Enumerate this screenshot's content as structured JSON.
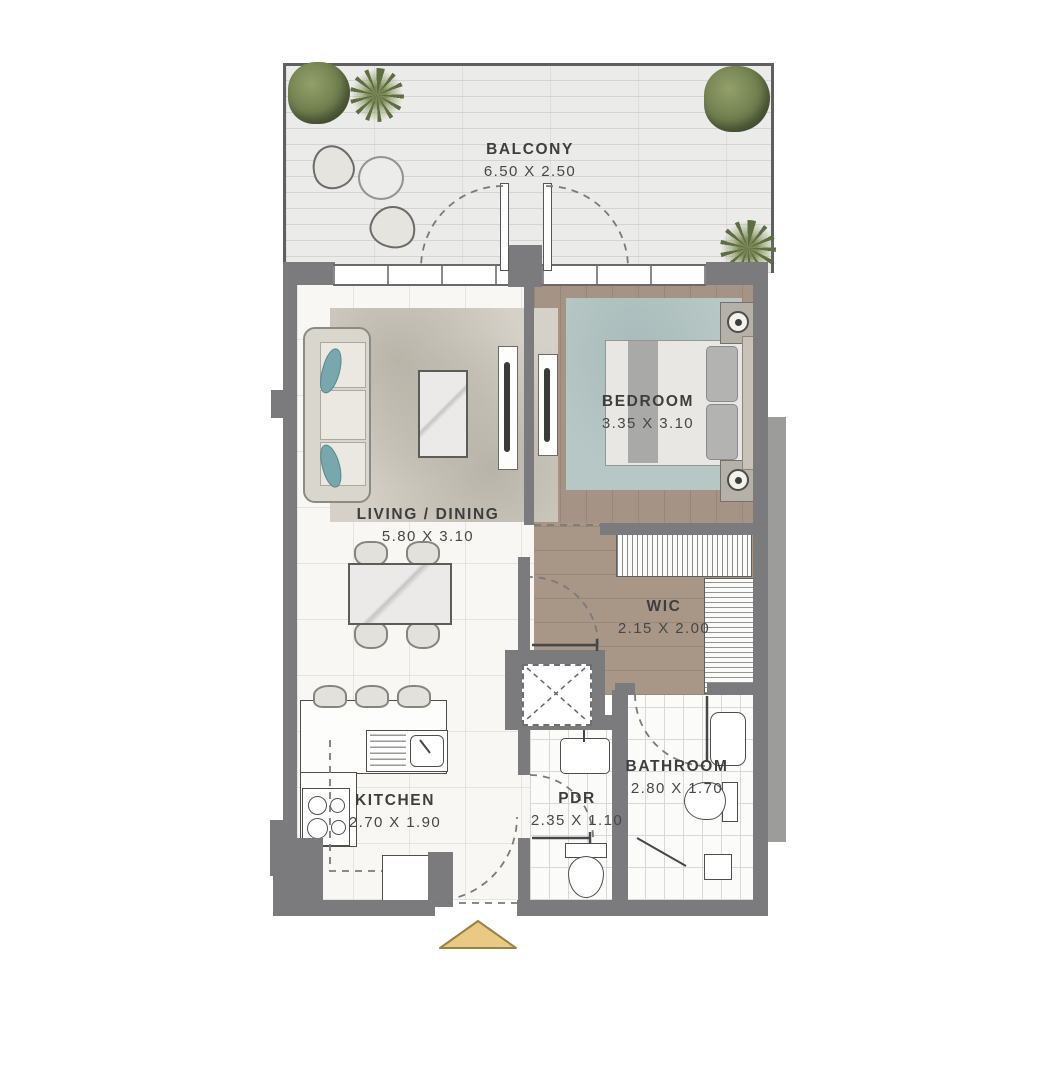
{
  "plan_title": "1-bedroom apartment floor plan",
  "rooms": [
    {
      "id": "balcony",
      "name": "BALCONY",
      "dims": "6.50 X 2.50"
    },
    {
      "id": "bedroom",
      "name": "BEDROOM",
      "dims": "3.35 X 3.10"
    },
    {
      "id": "living-dining",
      "name": "LIVING / DINING",
      "dims": "5.80 X 3.10"
    },
    {
      "id": "wic",
      "name": "WIC",
      "dims": "2.15 X 2.00"
    },
    {
      "id": "kitchen",
      "name": "KITCHEN",
      "dims": "2.70 X 1.90"
    },
    {
      "id": "bathroom",
      "name": "BATHROOM",
      "dims": "2.80 X 1.70"
    },
    {
      "id": "pdr",
      "name": "PDR",
      "dims": "2.35 X 1.10"
    }
  ],
  "colors": {
    "wall": "#7b7b7d",
    "wall_light": "#9c9c9a",
    "wood_floor": "#a59486",
    "marble_floor": "#f8f7f4",
    "balcony_floor": "#ebebe9",
    "tile_floor": "#fbfbfa",
    "bedroom_rug": "#b7c7c5",
    "living_rug": "#d5d1c8",
    "accent_pillow": "#78a7ad",
    "entry_arrow": "#eac982",
    "plant_green": "#6d7c4c",
    "label_text": "#3e3e3e"
  },
  "icons": [
    "plant-bush-icon",
    "plant-palm-icon",
    "entry-arrow",
    "door-swing-arc",
    "shaft-x-mark",
    "sink-icon",
    "toilet-icon",
    "cooktop-icon"
  ]
}
